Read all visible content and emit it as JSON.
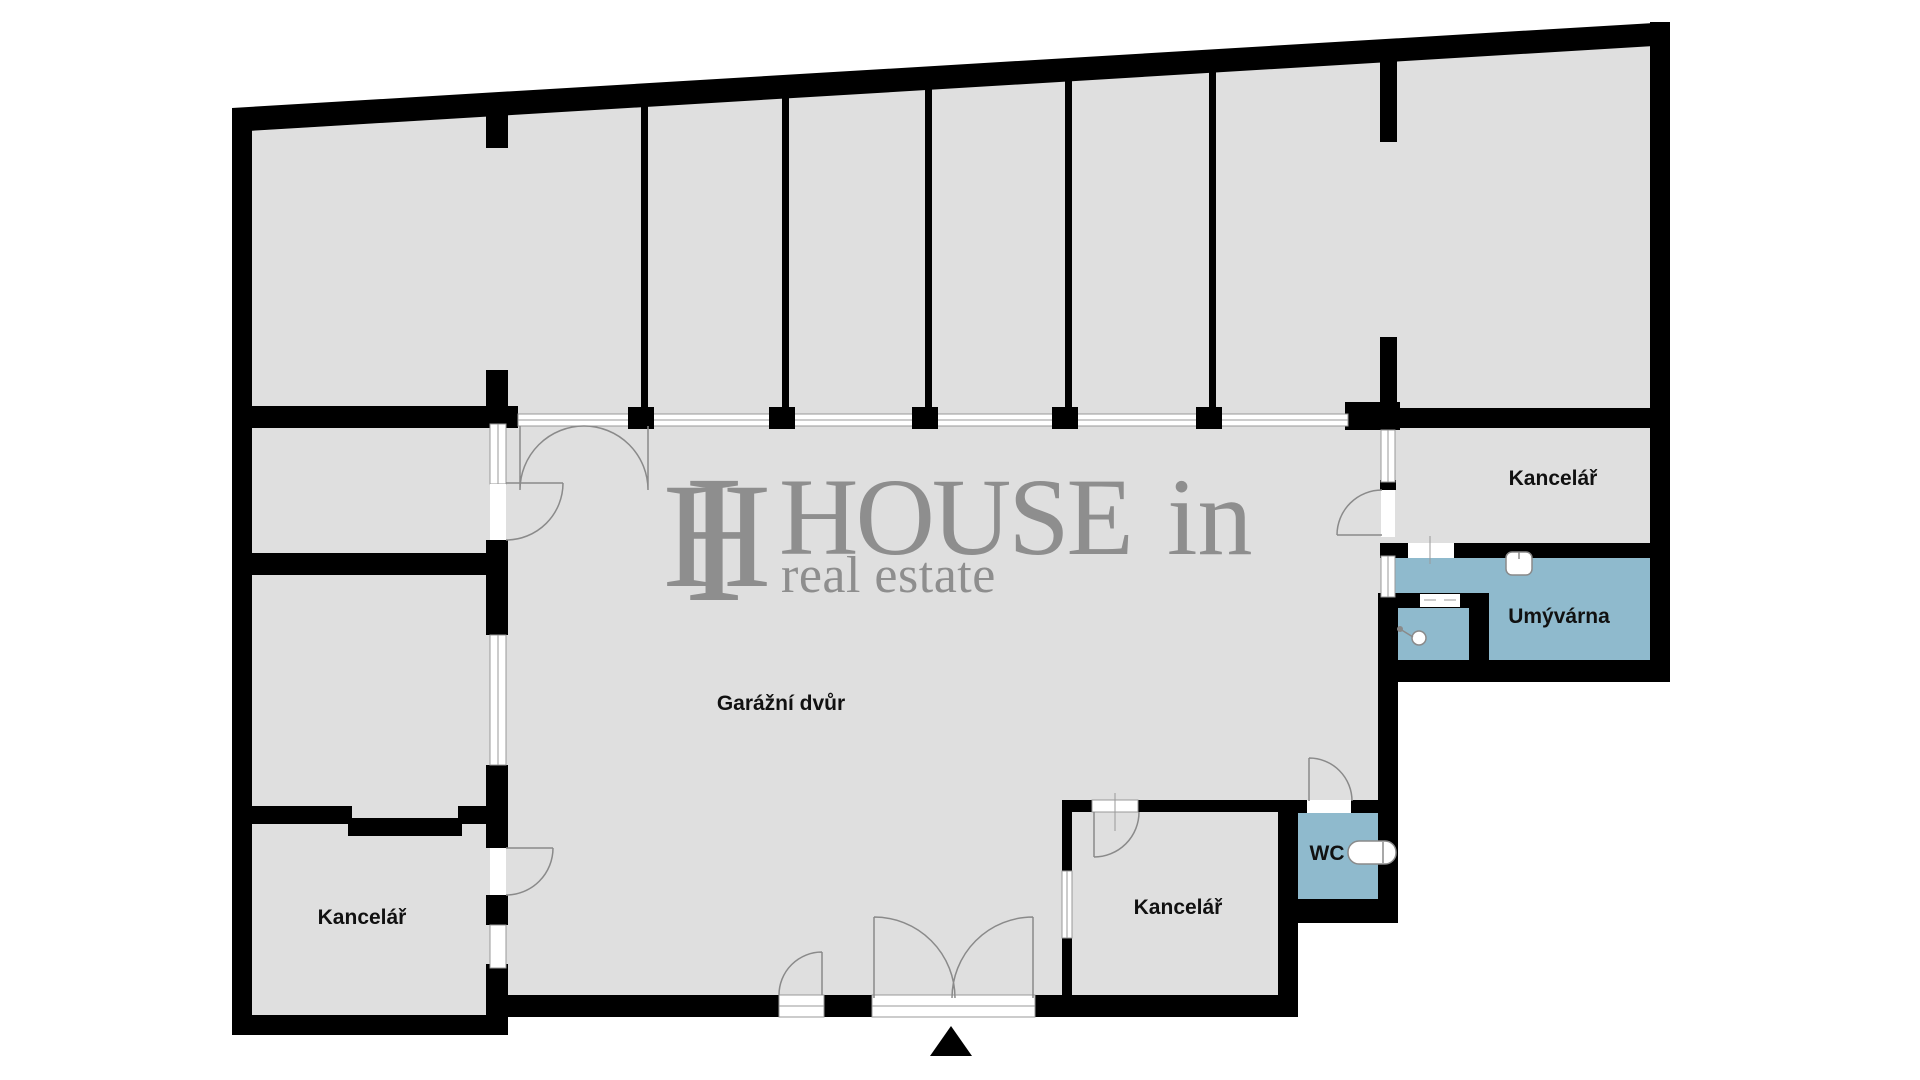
{
  "plan": {
    "type": "floor-plan",
    "width_px": 1920,
    "height_px": 1080
  },
  "rooms": {
    "garage_yard": {
      "label": "Garážní dvůr"
    },
    "office_top_right": {
      "label": "Kancelář"
    },
    "washroom": {
      "label": "Umývárna"
    },
    "wc": {
      "label": "WC"
    },
    "office_bottom_right": {
      "label": "Kancelář"
    },
    "office_bottom_left": {
      "label": "Kancelář"
    }
  },
  "watermark": {
    "monogram_h": "H",
    "monogram_i": "I",
    "brand": "HOUSE",
    "brand_suffix": "in",
    "tagline": "real estate"
  },
  "colors": {
    "wall": "#000000",
    "floor": "#dfdfdf",
    "wet_room": "#8fbacd",
    "window_line": "#9a9a9a",
    "door_arc": "#8a8a8a",
    "watermark": "#8e8e8e",
    "label": "#111111",
    "background": "#ffffff"
  }
}
